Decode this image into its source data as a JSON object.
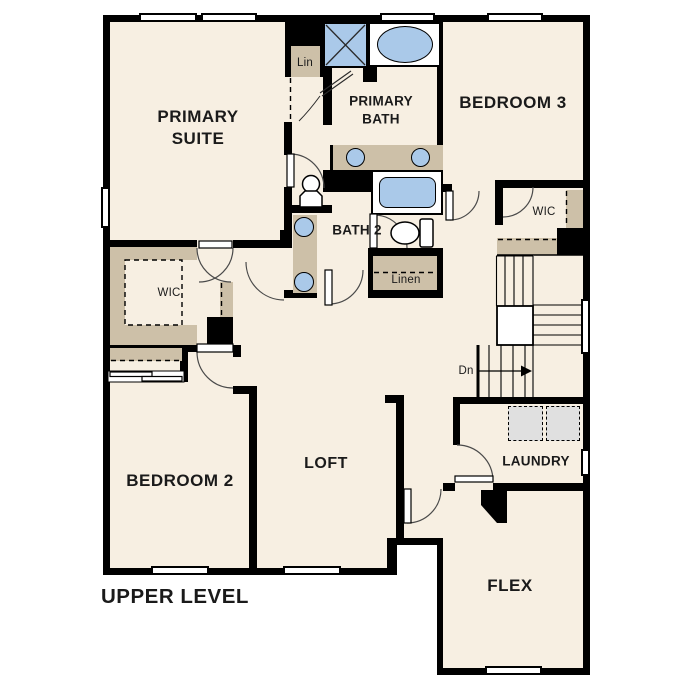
{
  "plan": {
    "level_title": "UPPER LEVEL"
  },
  "rooms": {
    "primary_suite": {
      "line1": "PRIMARY",
      "line2": "SUITE"
    },
    "primary_bath": {
      "line1": "PRIMARY",
      "line2": "BATH"
    },
    "bedroom3": {
      "label": "BEDROOM 3"
    },
    "bedroom2": {
      "label": "BEDROOM 2"
    },
    "bath2": {
      "label": "BATH 2"
    },
    "loft": {
      "label": "LOFT"
    },
    "laundry": {
      "label": "LAUNDRY"
    },
    "flex": {
      "label": "FLEX"
    }
  },
  "closets": {
    "wic_primary": {
      "label": "WIC"
    },
    "wic_bedroom3": {
      "label": "WIC"
    },
    "linen": {
      "label": "Linen"
    },
    "lin": {
      "label": "Lin"
    }
  },
  "stairs": {
    "down_label": "Dn",
    "direction": "down"
  },
  "fixtures": {
    "primary_bath": [
      "shower",
      "bathtub",
      "double-sink-vanity",
      "toilet"
    ],
    "bath2": [
      "bathtub",
      "double-sink-vanity",
      "toilet"
    ],
    "laundry": [
      "washer",
      "dryer"
    ],
    "bedroom2_closet": [
      "bypass-sliding-door",
      "shelf"
    ],
    "wic_shelving": [
      "shelf"
    ]
  },
  "colors": {
    "floor": "#f7efe2",
    "wall": "#000000",
    "counter_tan": "#cdc0a8",
    "fixture_blue": "#aac9e9",
    "appliance_gray": "#e0e0e0",
    "background": "#ffffff"
  }
}
